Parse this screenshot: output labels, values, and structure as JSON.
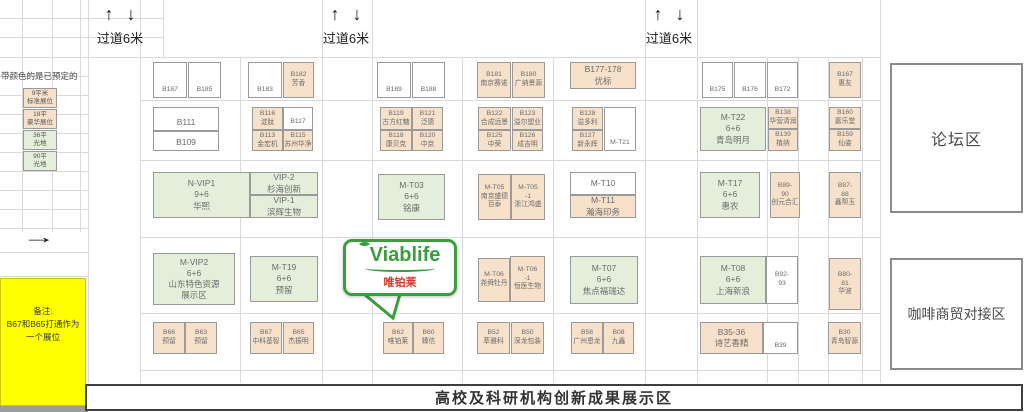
{
  "aisle": {
    "up_arrow": "↑",
    "down_arrow": "↓"
  },
  "aisles": [
    {
      "label": "过道6米"
    },
    {
      "label": "过道6米"
    },
    {
      "label": "过道6米"
    }
  ],
  "legend": {
    "header": "带颜色的是已预定的",
    "arrow": "→",
    "samples": [
      {
        "lines": [
          "9平米",
          "标准展位"
        ],
        "color": "o"
      },
      {
        "lines": [
          "18平",
          "豪华展位"
        ],
        "color": "o"
      },
      {
        "lines": [
          "36平",
          "光地"
        ],
        "color": "g"
      },
      {
        "lines": [
          "90平",
          "光地"
        ],
        "color": "g"
      }
    ],
    "note_lines": [
      "备注:",
      "B67和B65打通作为",
      "一个展位"
    ]
  },
  "zones": {
    "forum": "论坛区",
    "coffee": "咖啡商贸对接区",
    "banner": "高校及科研机构创新成果展示区"
  },
  "logo": {
    "brand": "Viablife",
    "cn": "唯铂莱"
  },
  "colors": {
    "orange": "#f8e1ca",
    "green": "#e3efda",
    "yellow": "#ffff00",
    "logo_green": "#3a9e3d",
    "cn_red": "#d43a2a",
    "grid": "#d9d9d9"
  },
  "booths": [
    {
      "id": "B187",
      "lines": [
        "B187"
      ],
      "c": "w",
      "x": 153,
      "y": 62,
      "w": 34,
      "h": 36,
      "align": "end"
    },
    {
      "id": "B185",
      "lines": [
        "B185"
      ],
      "c": "w",
      "x": 188,
      "y": 62,
      "w": 33,
      "h": 36,
      "align": "end"
    },
    {
      "id": "B183",
      "lines": [
        "B183"
      ],
      "c": "w",
      "x": 248,
      "y": 62,
      "w": 34,
      "h": 36,
      "align": "end"
    },
    {
      "id": "B182",
      "lines": [
        "B182",
        "芳香"
      ],
      "c": "o",
      "x": 283,
      "y": 62,
      "w": 31,
      "h": 36
    },
    {
      "id": "B189",
      "lines": [
        "B189"
      ],
      "c": "w",
      "x": 377,
      "y": 62,
      "w": 34,
      "h": 36,
      "align": "end"
    },
    {
      "id": "B188",
      "lines": [
        "B188"
      ],
      "c": "w",
      "x": 412,
      "y": 62,
      "w": 33,
      "h": 36,
      "align": "end"
    },
    {
      "id": "B181",
      "lines": [
        "B181",
        "南京赛诺"
      ],
      "c": "o",
      "x": 477,
      "y": 62,
      "w": 34,
      "h": 36
    },
    {
      "id": "B180",
      "lines": [
        "B180",
        "广纳景源"
      ],
      "c": "o",
      "x": 512,
      "y": 62,
      "w": 33,
      "h": 36
    },
    {
      "id": "B177-178",
      "lines": [
        "B177-178",
        "优标"
      ],
      "c": "o",
      "x": 570,
      "y": 62,
      "w": 66,
      "h": 27
    },
    {
      "id": "B175",
      "lines": [
        "B175"
      ],
      "c": "w",
      "x": 702,
      "y": 62,
      "w": 31,
      "h": 36,
      "align": "end"
    },
    {
      "id": "B176",
      "lines": [
        "B176"
      ],
      "c": "w",
      "x": 734,
      "y": 62,
      "w": 32,
      "h": 36,
      "align": "end"
    },
    {
      "id": "B172",
      "lines": [
        "B172"
      ],
      "c": "w",
      "x": 767,
      "y": 62,
      "w": 31,
      "h": 36,
      "align": "end"
    },
    {
      "id": "B167",
      "lines": [
        "B167",
        "惠友"
      ],
      "c": "o",
      "x": 829,
      "y": 62,
      "w": 32,
      "h": 36
    },
    {
      "id": "B111",
      "lines": [
        "B111"
      ],
      "c": "w",
      "x": 153,
      "y": 107,
      "w": 66,
      "h": 24,
      "align": "end"
    },
    {
      "id": "B109",
      "lines": [
        "B109"
      ],
      "c": "w",
      "x": 153,
      "y": 131,
      "w": 66,
      "h": 20,
      "align": "end"
    },
    {
      "id": "B116",
      "lines": [
        "B116",
        "淀肽"
      ],
      "c": "o",
      "x": 252,
      "y": 107,
      "w": 31,
      "h": 23
    },
    {
      "id": "B117",
      "lines": [
        "B117"
      ],
      "c": "w",
      "x": 283,
      "y": 107,
      "w": 30,
      "h": 23,
      "align": "end"
    },
    {
      "id": "B113",
      "lines": [
        "B113",
        "金宏机"
      ],
      "c": "o",
      "x": 252,
      "y": 130,
      "w": 31,
      "h": 21
    },
    {
      "id": "B115",
      "lines": [
        "B115",
        "苏州华净"
      ],
      "c": "o",
      "x": 283,
      "y": 130,
      "w": 30,
      "h": 21
    },
    {
      "id": "B119",
      "lines": [
        "B119",
        "古方红糖"
      ],
      "c": "o",
      "x": 380,
      "y": 107,
      "w": 32,
      "h": 23
    },
    {
      "id": "B121",
      "lines": [
        "B121",
        "泛德"
      ],
      "c": "o",
      "x": 412,
      "y": 107,
      "w": 31,
      "h": 23
    },
    {
      "id": "B118",
      "lines": [
        "B118",
        "康贝克"
      ],
      "c": "o",
      "x": 380,
      "y": 130,
      "w": 32,
      "h": 21
    },
    {
      "id": "B120",
      "lines": [
        "B120",
        "中京"
      ],
      "c": "o",
      "x": 412,
      "y": 130,
      "w": 31,
      "h": 21
    },
    {
      "id": "B122",
      "lines": [
        "B122",
        "合成远景"
      ],
      "c": "o",
      "x": 478,
      "y": 107,
      "w": 33,
      "h": 23
    },
    {
      "id": "B123",
      "lines": [
        "B123",
        "溢尔塑业"
      ],
      "c": "o",
      "x": 512,
      "y": 107,
      "w": 31,
      "h": 23
    },
    {
      "id": "B125",
      "lines": [
        "B125",
        "中荣"
      ],
      "c": "o",
      "x": 478,
      "y": 130,
      "w": 33,
      "h": 21
    },
    {
      "id": "B126",
      "lines": [
        "B126",
        "成吉明"
      ],
      "c": "o",
      "x": 512,
      "y": 130,
      "w": 31,
      "h": 21
    },
    {
      "id": "B128",
      "lines": [
        "B128",
        "溢多利"
      ],
      "c": "o",
      "x": 572,
      "y": 107,
      "w": 31,
      "h": 23
    },
    {
      "id": "B127",
      "lines": [
        "B127",
        "新永辉"
      ],
      "c": "o",
      "x": 572,
      "y": 130,
      "w": 31,
      "h": 21
    },
    {
      "id": "M-T21",
      "lines": [
        "M-T21"
      ],
      "c": "w",
      "x": 604,
      "y": 107,
      "w": 32,
      "h": 44,
      "align": "end"
    },
    {
      "id": "M-T22",
      "lines": [
        "M-T22",
        "6+6",
        "青岛明月"
      ],
      "c": "g",
      "x": 700,
      "y": 107,
      "w": 66,
      "h": 44
    },
    {
      "id": "B138",
      "lines": [
        "B138",
        "华营清润"
      ],
      "c": "o",
      "x": 768,
      "y": 107,
      "w": 30,
      "h": 22
    },
    {
      "id": "B139",
      "lines": [
        "B139",
        "植纳"
      ],
      "c": "o",
      "x": 768,
      "y": 129,
      "w": 30,
      "h": 22
    },
    {
      "id": "B160",
      "lines": [
        "B160",
        "嘉乐堂"
      ],
      "c": "o",
      "x": 829,
      "y": 107,
      "w": 32,
      "h": 22
    },
    {
      "id": "B159",
      "lines": [
        "B159",
        "仙姿"
      ],
      "c": "o",
      "x": 829,
      "y": 129,
      "w": 32,
      "h": 22
    },
    {
      "id": "N-VIP1",
      "lines": [
        "N-VIP1",
        "9+6",
        "华熙"
      ],
      "c": "g",
      "x": 153,
      "y": 172,
      "w": 97,
      "h": 46
    },
    {
      "id": "VIP-2",
      "lines": [
        "VIP-2",
        "杉海创新"
      ],
      "c": "g",
      "x": 250,
      "y": 172,
      "w": 68,
      "h": 23
    },
    {
      "id": "VIP-1",
      "lines": [
        "VIP-1",
        "滨辉生物"
      ],
      "c": "g",
      "x": 250,
      "y": 195,
      "w": 68,
      "h": 23
    },
    {
      "id": "M-T03",
      "lines": [
        "M-T03",
        "6+6",
        "铭康"
      ],
      "c": "g",
      "x": 378,
      "y": 174,
      "w": 67,
      "h": 46
    },
    {
      "id": "M-T05",
      "lines": [
        "M-T05",
        "南京盛德",
        "百泰"
      ],
      "c": "o",
      "x": 478,
      "y": 174,
      "w": 33,
      "h": 46
    },
    {
      "id": "M-T05-1",
      "lines": [
        "M-T05",
        "-1",
        "浙江鸿盛"
      ],
      "c": "o",
      "x": 511,
      "y": 174,
      "w": 34,
      "h": 46
    },
    {
      "id": "M-T10",
      "lines": [
        "M-T10"
      ],
      "c": "w",
      "x": 570,
      "y": 172,
      "w": 66,
      "h": 23
    },
    {
      "id": "M-T11",
      "lines": [
        "M-T11",
        "瀚海印务"
      ],
      "c": "o",
      "x": 570,
      "y": 195,
      "w": 66,
      "h": 23
    },
    {
      "id": "M-T17",
      "lines": [
        "M-T17",
        "6+6",
        "惠农"
      ],
      "c": "g",
      "x": 700,
      "y": 172,
      "w": 60,
      "h": 46
    },
    {
      "id": "B89-90",
      "lines": [
        "B89-",
        "90",
        "创元合汇"
      ],
      "c": "o",
      "x": 770,
      "y": 172,
      "w": 30,
      "h": 46
    },
    {
      "id": "B87-88",
      "lines": [
        "B87-",
        "88",
        "鑫帮玉"
      ],
      "c": "o",
      "x": 829,
      "y": 172,
      "w": 32,
      "h": 46
    },
    {
      "id": "M-VIP2",
      "lines": [
        "M-VIP2",
        "6+6",
        "山东特色资源",
        "展示区"
      ],
      "c": "g",
      "x": 153,
      "y": 253,
      "w": 82,
      "h": 52
    },
    {
      "id": "M-T19",
      "lines": [
        "M-T19",
        "6+6",
        "预留"
      ],
      "c": "g",
      "x": 250,
      "y": 256,
      "w": 68,
      "h": 46
    },
    {
      "id": "M-T06",
      "lines": [
        "M-T06",
        "尧舜牡丹"
      ],
      "c": "o",
      "x": 478,
      "y": 258,
      "w": 32,
      "h": 44
    },
    {
      "id": "M-T06-1",
      "lines": [
        "M-T06",
        "-1",
        "恒医生物"
      ],
      "c": "o",
      "x": 510,
      "y": 256,
      "w": 35,
      "h": 46
    },
    {
      "id": "M-T07",
      "lines": [
        "M-T07",
        "6+6",
        "焦点福瑞达"
      ],
      "c": "g",
      "x": 570,
      "y": 256,
      "w": 68,
      "h": 48
    },
    {
      "id": "M-T08",
      "lines": [
        "M-T08",
        "6+6",
        "上海新浪"
      ],
      "c": "g",
      "x": 700,
      "y": 256,
      "w": 66,
      "h": 48
    },
    {
      "id": "B92-93",
      "lines": [
        "B92-",
        "93"
      ],
      "c": "w",
      "x": 766,
      "y": 256,
      "w": 32,
      "h": 48
    },
    {
      "id": "B80-81",
      "lines": [
        "B80-",
        "81",
        "华波"
      ],
      "c": "o",
      "x": 829,
      "y": 258,
      "w": 32,
      "h": 52
    },
    {
      "id": "B66",
      "lines": [
        "B66",
        "预留"
      ],
      "c": "o",
      "x": 153,
      "y": 322,
      "w": 32,
      "h": 32
    },
    {
      "id": "B63",
      "lines": [
        "B63",
        "预留"
      ],
      "c": "o",
      "x": 185,
      "y": 322,
      "w": 32,
      "h": 32
    },
    {
      "id": "B67",
      "lines": [
        "B67",
        "中科基智"
      ],
      "c": "o",
      "x": 250,
      "y": 322,
      "w": 32,
      "h": 32
    },
    {
      "id": "B65",
      "lines": [
        "B65",
        "杰振明"
      ],
      "c": "o",
      "x": 283,
      "y": 322,
      "w": 31,
      "h": 32
    },
    {
      "id": "B62",
      "lines": [
        "B62",
        "唯铂莱"
      ],
      "c": "o",
      "x": 383,
      "y": 322,
      "w": 30,
      "h": 32
    },
    {
      "id": "B60",
      "lines": [
        "B60",
        "臻信"
      ],
      "c": "o",
      "x": 413,
      "y": 322,
      "w": 31,
      "h": 32
    },
    {
      "id": "B52",
      "lines": [
        "B52",
        "萃雅科"
      ],
      "c": "o",
      "x": 477,
      "y": 322,
      "w": 33,
      "h": 32
    },
    {
      "id": "B50",
      "lines": [
        "B50",
        "深龙包装"
      ],
      "c": "o",
      "x": 511,
      "y": 322,
      "w": 33,
      "h": 32
    },
    {
      "id": "B58",
      "lines": [
        "B58",
        "广州恩龙"
      ],
      "c": "o",
      "x": 571,
      "y": 322,
      "w": 32,
      "h": 32
    },
    {
      "id": "B08",
      "lines": [
        "B08",
        "九鑫"
      ],
      "c": "o",
      "x": 603,
      "y": 322,
      "w": 31,
      "h": 32
    },
    {
      "id": "B35-36",
      "lines": [
        "B35-36",
        "诗艺香精"
      ],
      "c": "o",
      "x": 700,
      "y": 322,
      "w": 63,
      "h": 32
    },
    {
      "id": "B39",
      "lines": [
        "B39"
      ],
      "c": "w",
      "x": 763,
      "y": 322,
      "w": 35,
      "h": 32,
      "align": "end"
    },
    {
      "id": "B30",
      "lines": [
        "B30",
        "青岛智源"
      ],
      "c": "o",
      "x": 828,
      "y": 322,
      "w": 33,
      "h": 32
    }
  ]
}
